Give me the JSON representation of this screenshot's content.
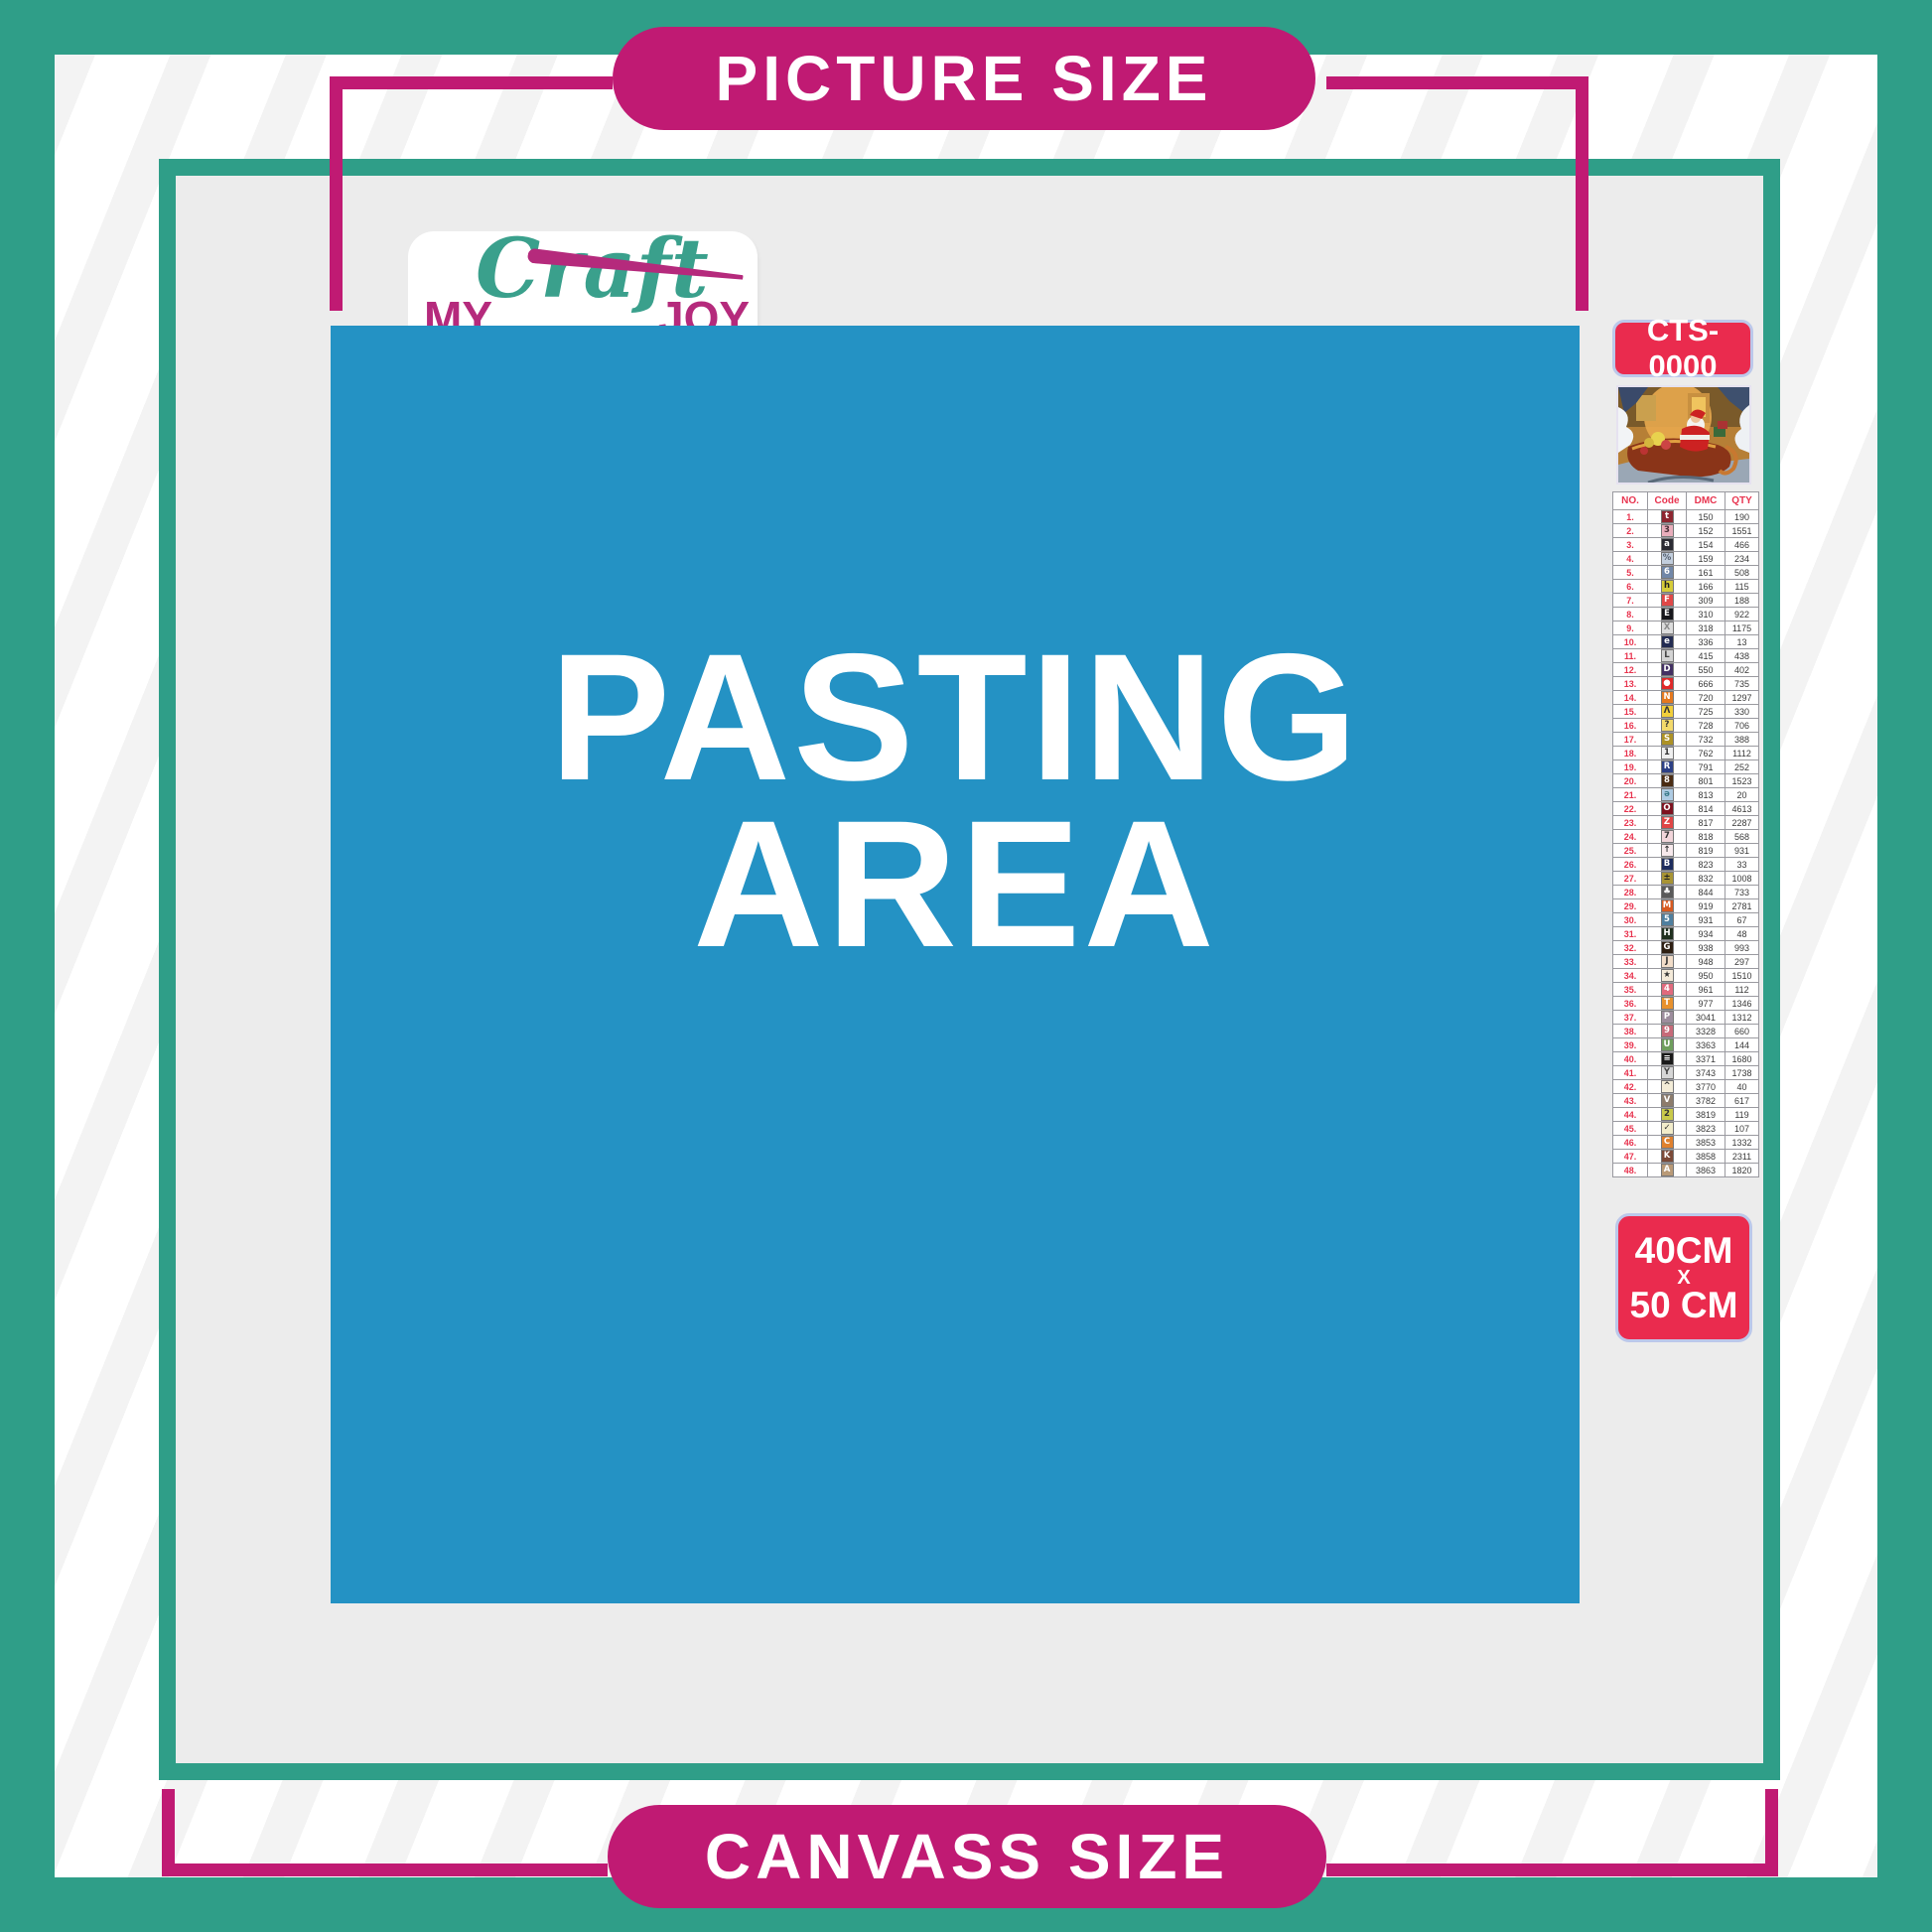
{
  "colors": {
    "teal": "#2f9e88",
    "magenta": "#c01a73",
    "pasting_blue": "#2492c4",
    "badge_red": "#ea2b4e",
    "canvas_gray": "#ececec",
    "table_accent_red": "#e8344f"
  },
  "top_banner": {
    "label": "PICTURE SIZE"
  },
  "bottom_banner": {
    "label": "CANVASS SIZE"
  },
  "logo": {
    "word1": "MY",
    "word2": "Craft",
    "word3": "JOY"
  },
  "pasting_area": {
    "line1": "PASTING",
    "line2": "AREA"
  },
  "sidebar": {
    "sku_label": "CTS-0000",
    "size_label": {
      "line1": "40CM",
      "line2": "X",
      "line3": "50 CM"
    },
    "table": {
      "headers": [
        "NO.",
        "Code",
        "DMC",
        "QTY"
      ],
      "rows": [
        {
          "no": "1.",
          "sym": "t",
          "bg": "#8e2630",
          "fg": "#ffffff",
          "dmc": "150",
          "qty": "190"
        },
        {
          "no": "2.",
          "sym": "3",
          "bg": "#e9aebc",
          "fg": "#4a3038",
          "dmc": "152",
          "qty": "1551"
        },
        {
          "no": "3.",
          "sym": "a",
          "bg": "#2b2b33",
          "fg": "#ffffff",
          "dmc": "154",
          "qty": "466"
        },
        {
          "no": "4.",
          "sym": "%",
          "bg": "#c2cedd",
          "fg": "#556070",
          "dmc": "159",
          "qty": "234"
        },
        {
          "no": "5.",
          "sym": "6",
          "bg": "#7187a8",
          "fg": "#ffffff",
          "dmc": "161",
          "qty": "508"
        },
        {
          "no": "6.",
          "sym": "h",
          "bg": "#d6cc39",
          "fg": "#222222",
          "dmc": "166",
          "qty": "115"
        },
        {
          "no": "7.",
          "sym": "F",
          "bg": "#e04848",
          "fg": "#ffffff",
          "dmc": "309",
          "qty": "188"
        },
        {
          "no": "8.",
          "sym": "E",
          "bg": "#17171c",
          "fg": "#ffffff",
          "dmc": "310",
          "qty": "922"
        },
        {
          "no": "9.",
          "sym": "X",
          "bg": "#dcdcdc",
          "fg": "#8a8a8a",
          "dmc": "318",
          "qty": "1175"
        },
        {
          "no": "10.",
          "sym": "e",
          "bg": "#232c52",
          "fg": "#ffffff",
          "dmc": "336",
          "qty": "13"
        },
        {
          "no": "11.",
          "sym": "L",
          "bg": "#d3d3d3",
          "fg": "#444444",
          "dmc": "415",
          "qty": "438"
        },
        {
          "no": "12.",
          "sym": "D",
          "bg": "#433063",
          "fg": "#ffffff",
          "dmc": "550",
          "qty": "402"
        },
        {
          "no": "13.",
          "sym": "●",
          "bg": "#e02a2a",
          "fg": "#ffffff",
          "dmc": "666",
          "qty": "735"
        },
        {
          "no": "14.",
          "sym": "N",
          "bg": "#e5791f",
          "fg": "#ffffff",
          "dmc": "720",
          "qty": "1297"
        },
        {
          "no": "15.",
          "sym": "Ʌ",
          "bg": "#f2cf3a",
          "fg": "#333333",
          "dmc": "725",
          "qty": "330"
        },
        {
          "no": "16.",
          "sym": "?",
          "bg": "#f3d96b",
          "fg": "#333333",
          "dmc": "728",
          "qty": "706"
        },
        {
          "no": "17.",
          "sym": "S",
          "bg": "#ad9225",
          "fg": "#ffffff",
          "dmc": "732",
          "qty": "388"
        },
        {
          "no": "18.",
          "sym": "1",
          "bg": "#efefef",
          "fg": "#333333",
          "dmc": "762",
          "qty": "1112"
        },
        {
          "no": "19.",
          "sym": "R",
          "bg": "#2c3f85",
          "fg": "#ffffff",
          "dmc": "791",
          "qty": "252"
        },
        {
          "no": "20.",
          "sym": "8",
          "bg": "#4a2c13",
          "fg": "#ffffff",
          "dmc": "801",
          "qty": "1523"
        },
        {
          "no": "21.",
          "sym": "ə",
          "bg": "#aecbe2",
          "fg": "#3a7a8a",
          "dmc": "813",
          "qty": "20"
        },
        {
          "no": "22.",
          "sym": "O",
          "bg": "#7e1220",
          "fg": "#ffffff",
          "dmc": "814",
          "qty": "4613"
        },
        {
          "no": "23.",
          "sym": "Z",
          "bg": "#e04545",
          "fg": "#ffffff",
          "dmc": "817",
          "qty": "2287"
        },
        {
          "no": "24.",
          "sym": "7",
          "bg": "#f2d5da",
          "fg": "#333333",
          "dmc": "818",
          "qty": "568"
        },
        {
          "no": "25.",
          "sym": "↑",
          "bg": "#f7e9ec",
          "fg": "#333333",
          "dmc": "819",
          "qty": "931"
        },
        {
          "no": "26.",
          "sym": "B",
          "bg": "#1d2c5e",
          "fg": "#ffffff",
          "dmc": "823",
          "qty": "33"
        },
        {
          "no": "27.",
          "sym": "±",
          "bg": "#a89434",
          "fg": "#222222",
          "dmc": "832",
          "qty": "1008"
        },
        {
          "no": "28.",
          "sym": "♣",
          "bg": "#5a5a5a",
          "fg": "#ffffff",
          "dmc": "844",
          "qty": "733"
        },
        {
          "no": "29.",
          "sym": "M",
          "bg": "#d85a20",
          "fg": "#ffffff",
          "dmc": "919",
          "qty": "2781"
        },
        {
          "no": "30.",
          "sym": "5",
          "bg": "#4f7f9f",
          "fg": "#ffffff",
          "dmc": "931",
          "qty": "67"
        },
        {
          "no": "31.",
          "sym": "H",
          "bg": "#20301f",
          "fg": "#ffffff",
          "dmc": "934",
          "qty": "48"
        },
        {
          "no": "32.",
          "sym": "G",
          "bg": "#2e1f12",
          "fg": "#ffffff",
          "dmc": "938",
          "qty": "993"
        },
        {
          "no": "33.",
          "sym": "J",
          "bg": "#f2ddc9",
          "fg": "#333333",
          "dmc": "948",
          "qty": "297"
        },
        {
          "no": "34.",
          "sym": "★",
          "bg": "#f4ead9",
          "fg": "#333333",
          "dmc": "950",
          "qty": "1510"
        },
        {
          "no": "35.",
          "sym": "4",
          "bg": "#e06a7d",
          "fg": "#ffffff",
          "dmc": "961",
          "qty": "112"
        },
        {
          "no": "36.",
          "sym": "T",
          "bg": "#e8912d",
          "fg": "#ffffff",
          "dmc": "977",
          "qty": "1346"
        },
        {
          "no": "37.",
          "sym": "P",
          "bg": "#9d8d9d",
          "fg": "#ffffff",
          "dmc": "3041",
          "qty": "1312"
        },
        {
          "no": "38.",
          "sym": "9",
          "bg": "#c76a79",
          "fg": "#ffffff",
          "dmc": "3328",
          "qty": "660"
        },
        {
          "no": "39.",
          "sym": "U",
          "bg": "#6f9e5d",
          "fg": "#ffffff",
          "dmc": "3363",
          "qty": "144"
        },
        {
          "no": "40.",
          "sym": "≡",
          "bg": "#1a1a1a",
          "fg": "#ffffff",
          "dmc": "3371",
          "qty": "1680"
        },
        {
          "no": "41.",
          "sym": "Y",
          "bg": "#d6d6d6",
          "fg": "#444444",
          "dmc": "3743",
          "qty": "1738"
        },
        {
          "no": "42.",
          "sym": "^",
          "bg": "#f3ecd7",
          "fg": "#333333",
          "dmc": "3770",
          "qty": "40"
        },
        {
          "no": "43.",
          "sym": "V",
          "bg": "#8d7c6c",
          "fg": "#ffffff",
          "dmc": "3782",
          "qty": "617"
        },
        {
          "no": "44.",
          "sym": "2",
          "bg": "#c9c94a",
          "fg": "#333333",
          "dmc": "3819",
          "qty": "119"
        },
        {
          "no": "45.",
          "sym": "✓",
          "bg": "#f2ecca",
          "fg": "#333333",
          "dmc": "3823",
          "qty": "107"
        },
        {
          "no": "46.",
          "sym": "C",
          "bg": "#e0812e",
          "fg": "#ffffff",
          "dmc": "3853",
          "qty": "1332"
        },
        {
          "no": "47.",
          "sym": "K",
          "bg": "#7c4a38",
          "fg": "#ffffff",
          "dmc": "3858",
          "qty": "2311"
        },
        {
          "no": "48.",
          "sym": "A",
          "bg": "#b99a77",
          "fg": "#ffffff",
          "dmc": "3863",
          "qty": "1820"
        }
      ]
    }
  }
}
